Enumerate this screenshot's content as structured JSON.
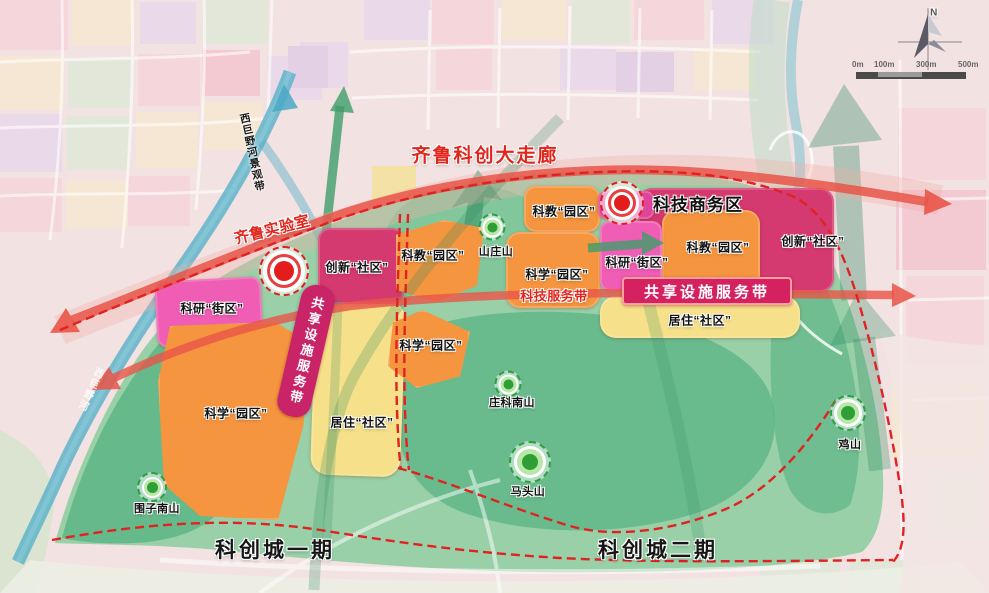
{
  "title": {
    "corridor": "齐鲁科创大走廊"
  },
  "landmarks": {
    "qilu_lab": "齐鲁实验室",
    "tech_business_district": "科技商务区"
  },
  "belts": {
    "shared_facility_east": "共享设施服务带",
    "shared_facility_west": "共享设施服务带",
    "tech_service": "科技服务带",
    "river_landscape": "西巨野河景观带",
    "river_faint": "西巨野河"
  },
  "districts": [
    {
      "id": "keyan-street-west",
      "label": "科研“街区”"
    },
    {
      "id": "kexue-park-west",
      "label": "科学“园区”"
    },
    {
      "id": "juzhu-community-west",
      "label": "居住“社区”"
    },
    {
      "id": "chuangxin-community-west",
      "label": "创新“社区”"
    },
    {
      "id": "kejiao-park-mid",
      "label": "科教“园区”"
    },
    {
      "id": "kejiao-park-north",
      "label": "科教“园区”"
    },
    {
      "id": "kexue-park-center",
      "label": "科学“园区”"
    },
    {
      "id": "kexue-park-south",
      "label": "科学“园区”"
    },
    {
      "id": "keyan-street-east",
      "label": "科研“街区”"
    },
    {
      "id": "kejiao-park-east",
      "label": "科教“园区”"
    },
    {
      "id": "chuangxin-community-east",
      "label": "创新“社区”"
    },
    {
      "id": "juzhu-community-east",
      "label": "居住“社区”"
    }
  ],
  "mountains": [
    {
      "name": "围子南山"
    },
    {
      "name": "山庄山"
    },
    {
      "name": "庄科南山"
    },
    {
      "name": "马头山"
    },
    {
      "name": "鸡山"
    }
  ],
  "phases": [
    {
      "name": "科创城一期"
    },
    {
      "name": "科创城二期"
    }
  ],
  "compass": {
    "north": "N"
  },
  "scale_bar": {
    "labels": [
      "0m",
      "100m",
      "300m",
      "500m"
    ]
  },
  "colors": {
    "corridor_red": "#e1251b",
    "arrow_band": "#e85548",
    "park_green": "#99d0a8",
    "hill_green": "#5cb586",
    "block_orange": "#f5953f",
    "block_pink": "#ef5db4",
    "block_crimson": "#d4396f",
    "block_yellow": "#f6e089",
    "banner_magenta": "#d5215f",
    "river_teal": "#58b0c8",
    "marker_red": "#e31c1c",
    "marker_green": "#2f9e35"
  }
}
